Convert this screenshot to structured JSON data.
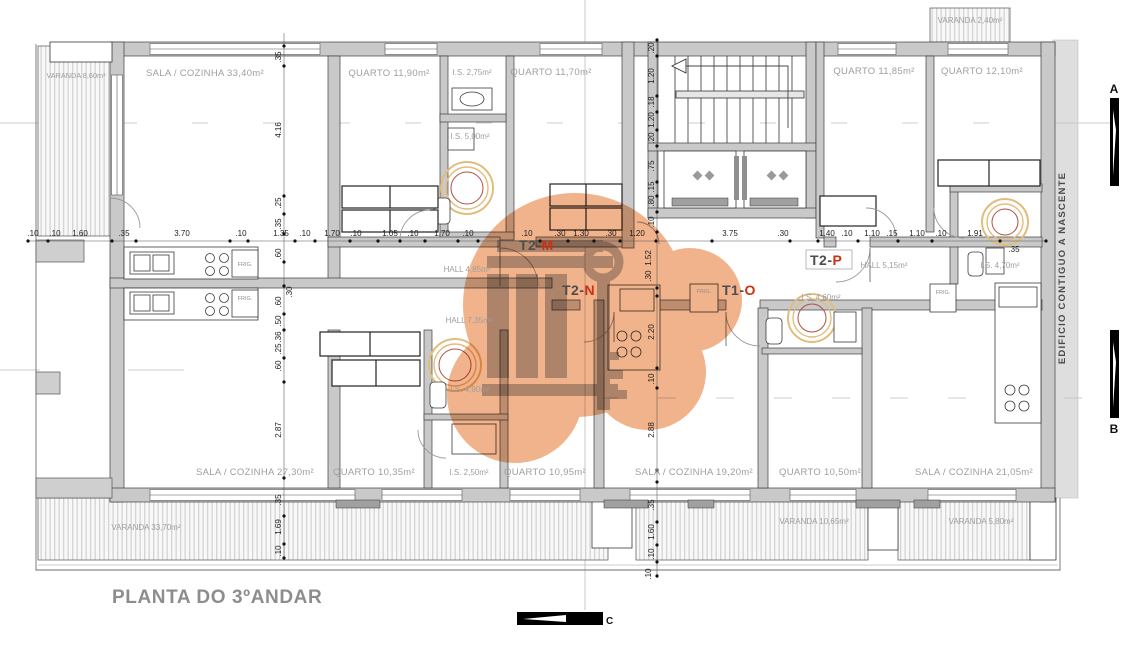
{
  "plan": {
    "title": "PLANTA DO 3ºANDAR",
    "side_building_note": "EDIFICIO CONTIGUO A NASCENTE",
    "appliance_label": "FRIG.",
    "section_markers": {
      "a": "A",
      "b": "B",
      "c": "C"
    },
    "units": {
      "t2m": {
        "prefix": "T2-",
        "letter": "M"
      },
      "t2n": {
        "prefix": "T2-",
        "letter": "N"
      },
      "t1o": {
        "prefix": "T1-",
        "letter": "O"
      },
      "t2p": {
        "prefix": "T2-",
        "letter": "P"
      }
    },
    "rooms": {
      "varanda_topleft": "VARANDA 8,60m²",
      "sala_3340": "SALA / COZINHA 33,40m²",
      "quarto_1190": "QUARTO 11,90m²",
      "is_275": "I.S. 2,75m²",
      "quarto_1170": "QUARTO 11,70m²",
      "is_500": "I.S. 5,00m²",
      "varanda_240": "VARANDA 2,40m²",
      "quarto_1185": "QUARTO 11,85m²",
      "quarto_1210": "QUARTO 12,10m²",
      "hall_485": "HALL 4,85m²",
      "hall_515": "HALL 5,15m²",
      "is_470": "I.S. 4,70m²",
      "hall_735": "HALL 7,35m²",
      "is_460": "I.S. 4,60m²",
      "is_490": "I.S. 4,90m²",
      "sala_2730": "SALA / COZINHA 27,30m²",
      "quarto_1035": "QUARTO 10,35m²",
      "s_250": "I.S. 2,50m²",
      "quarto_1095": "QUARTO 10,95m²",
      "sala_1920": "SALA / COZINHA 19,20m²",
      "quarto_1050": "QUARTO 10,50m²",
      "sala_2105": "SALA / COZINHA 21,05m²",
      "varanda_3370": "VARANDA 33,70m²",
      "varanda_1065": "VARANDA 10,65m²",
      "varanda_580": "VARANDA 5,80m²"
    },
    "dims": {
      "mid_chain": [
        ".10",
        ".10",
        "1.60",
        ".35",
        "3.70",
        ".10",
        "1.35",
        ".10",
        "1.70",
        ".10",
        "1.05",
        ".10",
        "1.70",
        ".10",
        ".10",
        ".30",
        "1.30",
        ".30",
        "1.20",
        "3.75",
        ".30",
        "1.40",
        ".10",
        "1.10",
        ".15",
        "1.10",
        ".10",
        "1.91",
        ".35"
      ],
      "left_upper": [
        ".35",
        "4.16",
        ".25",
        ".35"
      ],
      "left_lower": [
        ".60",
        ".30",
        ".60",
        ".50",
        ".36",
        ".25",
        ".60",
        "2.87",
        ".35",
        "1.69",
        ".10"
      ],
      "core_chain": [
        ".20",
        "1.20",
        ".18",
        "1.20",
        ".20",
        ".75",
        ".15",
        ".80",
        ".10",
        "1.52",
        ".30",
        "2.20",
        ".10",
        "2.88",
        ".35",
        "1.60",
        ".10",
        ".10"
      ]
    },
    "colors": {
      "watermark_orange": "#efa97c",
      "unit_letter_red": "#cd2f12",
      "wall_gray": "#c9c9c9",
      "label_gray": "#9e9e9e"
    }
  }
}
